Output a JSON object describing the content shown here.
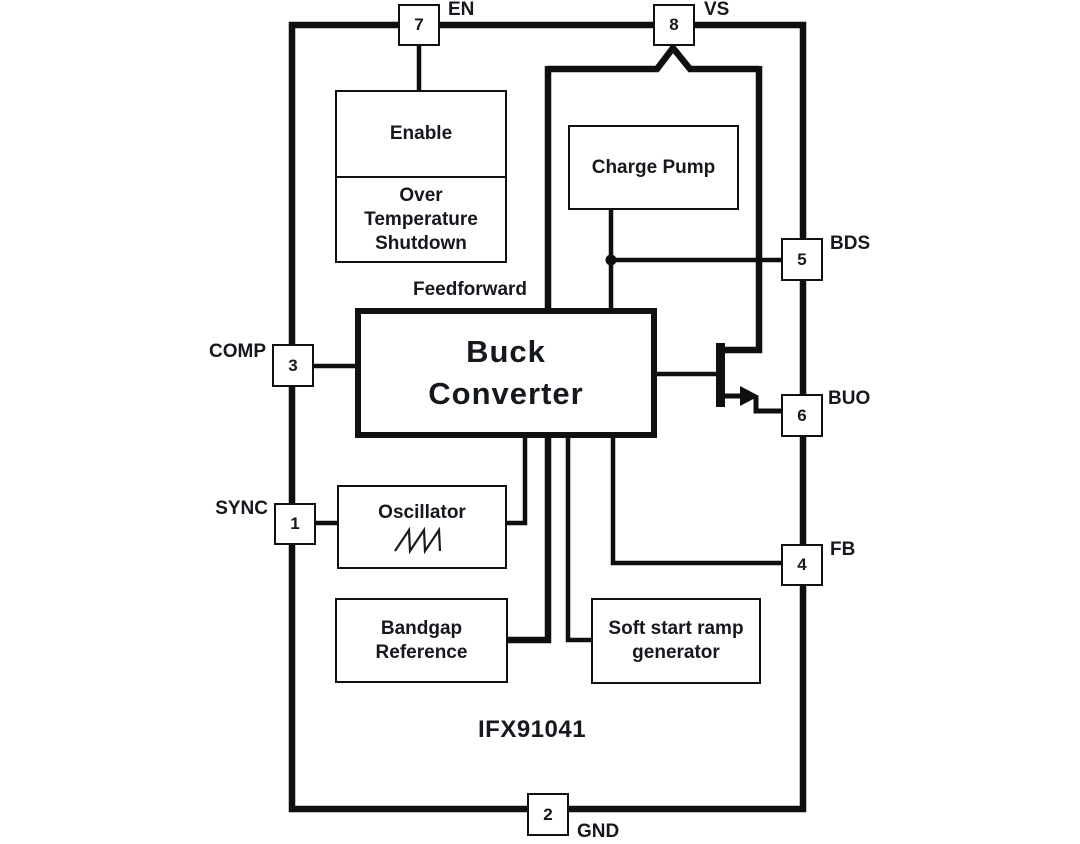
{
  "diagram": {
    "part_number": "IFX91041",
    "blocks": {
      "enable": "Enable",
      "over_temp": [
        "Over",
        "Temperature",
        "Shutdown"
      ],
      "charge_pump": "Charge Pump",
      "buck": [
        "Buck",
        "Converter"
      ],
      "feedforward": "Feedforward",
      "oscillator": "Oscillator",
      "bandgap": [
        "Bandgap",
        "Reference"
      ],
      "soft_start": [
        "Soft start ramp",
        "generator"
      ]
    },
    "pins": {
      "p1": {
        "num": "1",
        "label": "SYNC"
      },
      "p2": {
        "num": "2",
        "label": "GND"
      },
      "p3": {
        "num": "3",
        "label": "COMP"
      },
      "p4": {
        "num": "4",
        "label": "FB"
      },
      "p5": {
        "num": "5",
        "label": "BDS"
      },
      "p6": {
        "num": "6",
        "label": "BUO"
      },
      "p7": {
        "num": "7",
        "label": "EN"
      },
      "p8": {
        "num": "8",
        "label": "VS"
      }
    },
    "icons": {
      "transistor": "npn-pass-transistor",
      "waveform": "sawtooth-waveform"
    },
    "colors": {
      "line": "#0f0f0f",
      "text": "#15181d",
      "background": "#ffffff"
    }
  }
}
